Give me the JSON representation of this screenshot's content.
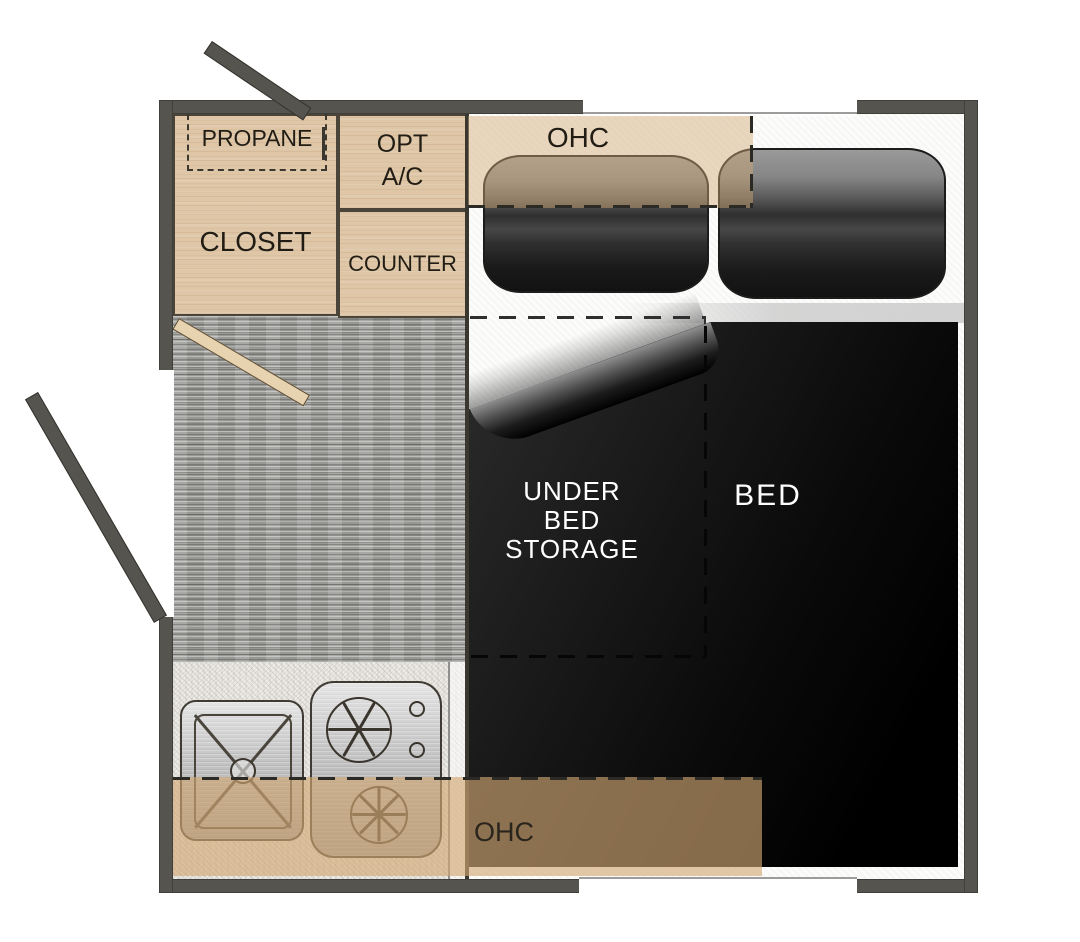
{
  "labels": {
    "propane": "PROPANE",
    "closet": "CLOSET",
    "opt_ac_line1": "OPT",
    "opt_ac_line2": "A/C",
    "counter": "COUNTER",
    "ohc_top": "OHC",
    "ohc_bottom": "OHC",
    "under_bed_line1": "UNDER",
    "under_bed_line2": "BED",
    "under_bed_line3": "STORAGE",
    "bed": "BED"
  },
  "colors": {
    "wall": "#56544e",
    "wood": "#dec6a7",
    "door_wood": "#e8d3b1",
    "carpet": "#a2a29f",
    "counter_surface": "#edebe7",
    "mattress": "#fcfcfb",
    "bed": "#111111",
    "ohc_overlay_top": "rgba(210,168,115,0.45)",
    "ohc_overlay_bottom": "rgba(210,168,115,0.63)",
    "stainless": "#c6c6c6",
    "label_dark": "#211d15",
    "label_light": "#ffffff"
  },
  "fixtures": {
    "sink": "kitchen-sink",
    "stove": "two-burner-stove",
    "pillow_count": 2,
    "doors": [
      "exterior-door-top",
      "exterior-door-left",
      "interior-door"
    ]
  }
}
